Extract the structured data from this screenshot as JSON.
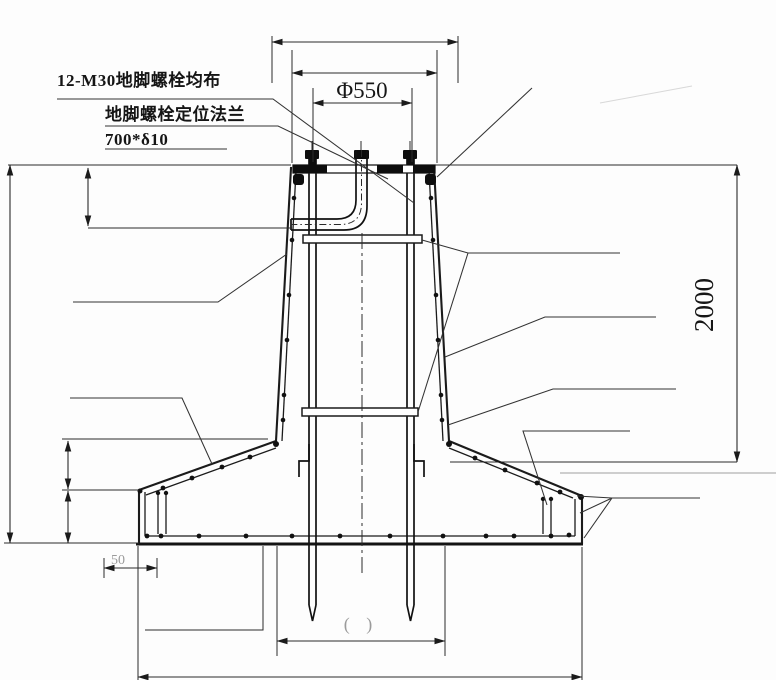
{
  "labels": {
    "anchor_bolts": "12-M30地脚螺栓均布",
    "positioning_flange": "地脚螺栓定位法兰",
    "flange_spec": "700*δ10",
    "bolt_circle_diameter": "Φ550",
    "embedment_depth": "2000",
    "edge_offset": "50",
    "blank_dim": "(    )"
  },
  "colors": {
    "line": "#1b1b1b",
    "faint": "#9b9b9b",
    "background": "#fdfdfd"
  }
}
